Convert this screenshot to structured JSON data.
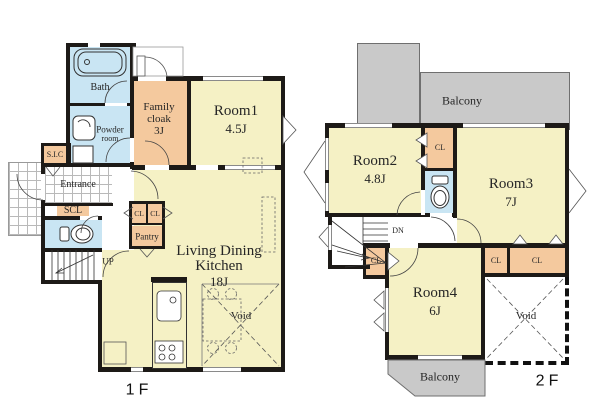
{
  "f1": {
    "label": "1F",
    "bath": "Bath",
    "powder_l1": "Powder",
    "powder_l2": "room",
    "family_l1": "Family",
    "family_l2": "cloak",
    "family_size": "3J",
    "room1": "Room1",
    "room1_size": "4.5J",
    "sic": "S.I.C",
    "entrance": "Entrance",
    "scl": "SCL",
    "cl_a": "CL",
    "cl_b": "CL",
    "pantry": "Pantry",
    "up": "UP",
    "ldk_l1": "Living Dining",
    "ldk_l2": "Kitchen",
    "ldk_size": "18J",
    "void": "Void"
  },
  "f2": {
    "label": "2F",
    "balcony_top": "Balcony",
    "room2": "Room2",
    "room2_size": "4.8J",
    "cl_top": "CL",
    "room3": "Room3",
    "room3_size": "7J",
    "dn": "DN",
    "cl_left": "CL",
    "cl_mid": "CL",
    "cl_right": "CL",
    "room4": "Room4",
    "room4_size": "6J",
    "void": "Void",
    "balcony_bottom": "Balcony"
  },
  "colors": {
    "room": "#f5f1c5",
    "closet": "#f4c99e",
    "wet": "#c9e5f3",
    "balcony": "#c9c9c9",
    "wall": "#1d1a17"
  }
}
